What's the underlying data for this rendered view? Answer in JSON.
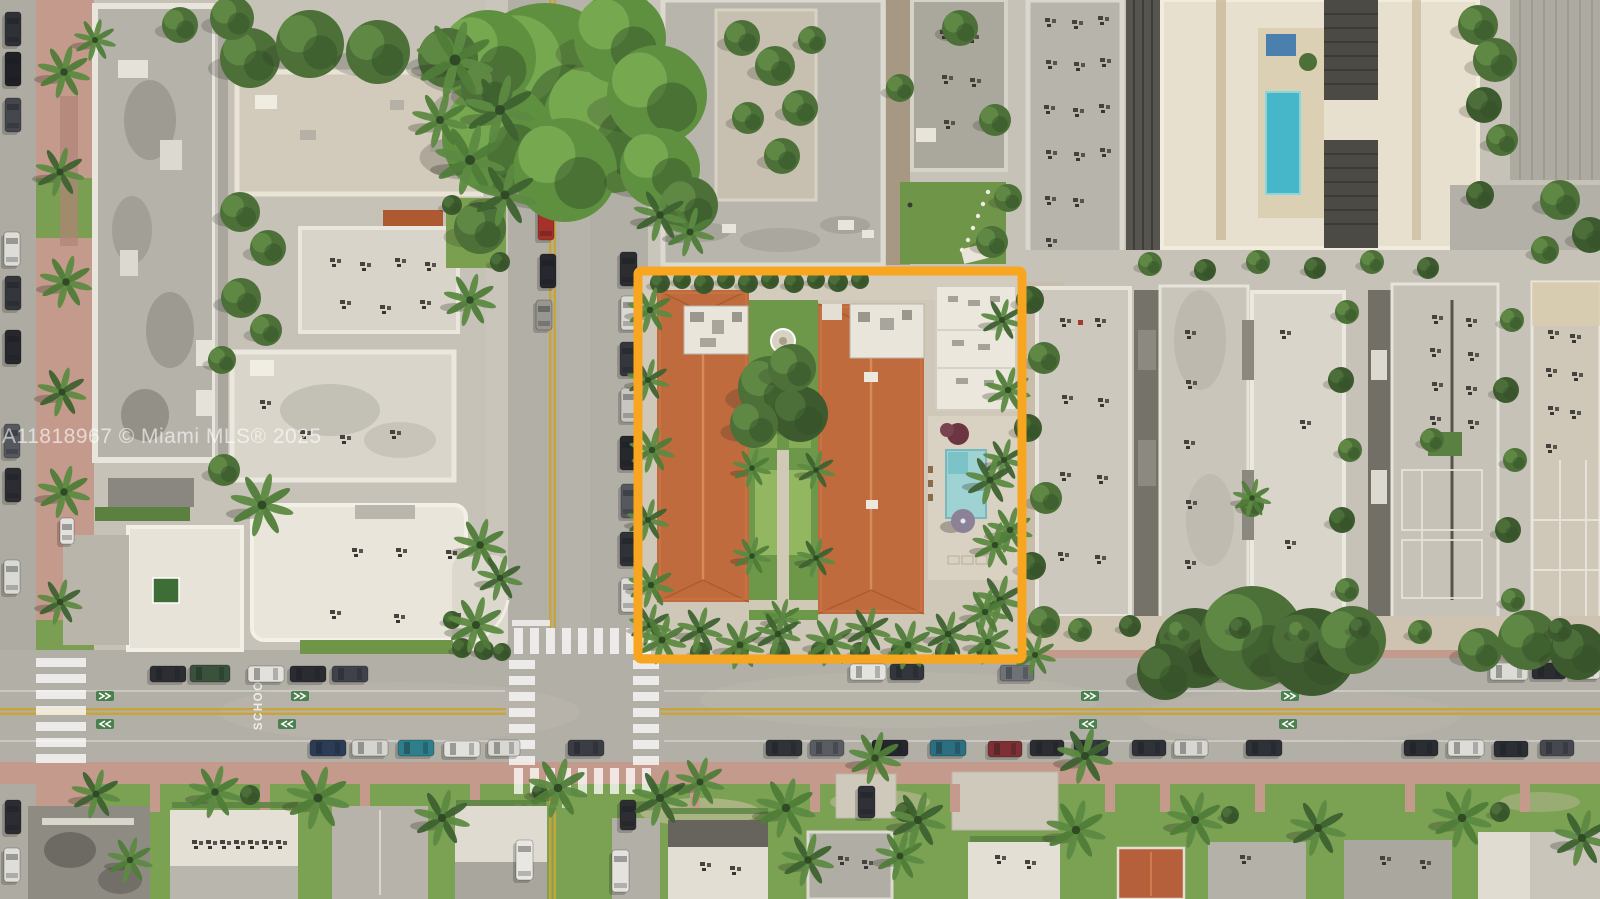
{
  "image": {
    "type": "aerial-drone-photo",
    "watermark": "A11818967 © Miami MLS® 2025",
    "pavement_text": "SCHOOL"
  },
  "highlight": {
    "label": "subject-property-outline",
    "color": "#F8A61F",
    "stroke_width": "9"
  },
  "colors": {
    "terracotta_roofs": "#BF6B3D",
    "pool_water": "#9FD2D2",
    "rooftop_pool": "#45B7C8",
    "lawn": "#7BA152",
    "asphalt": "#B2AFA6",
    "pink_sidewalk": "#C49A8C",
    "tree_canopy": "#5F9040"
  }
}
